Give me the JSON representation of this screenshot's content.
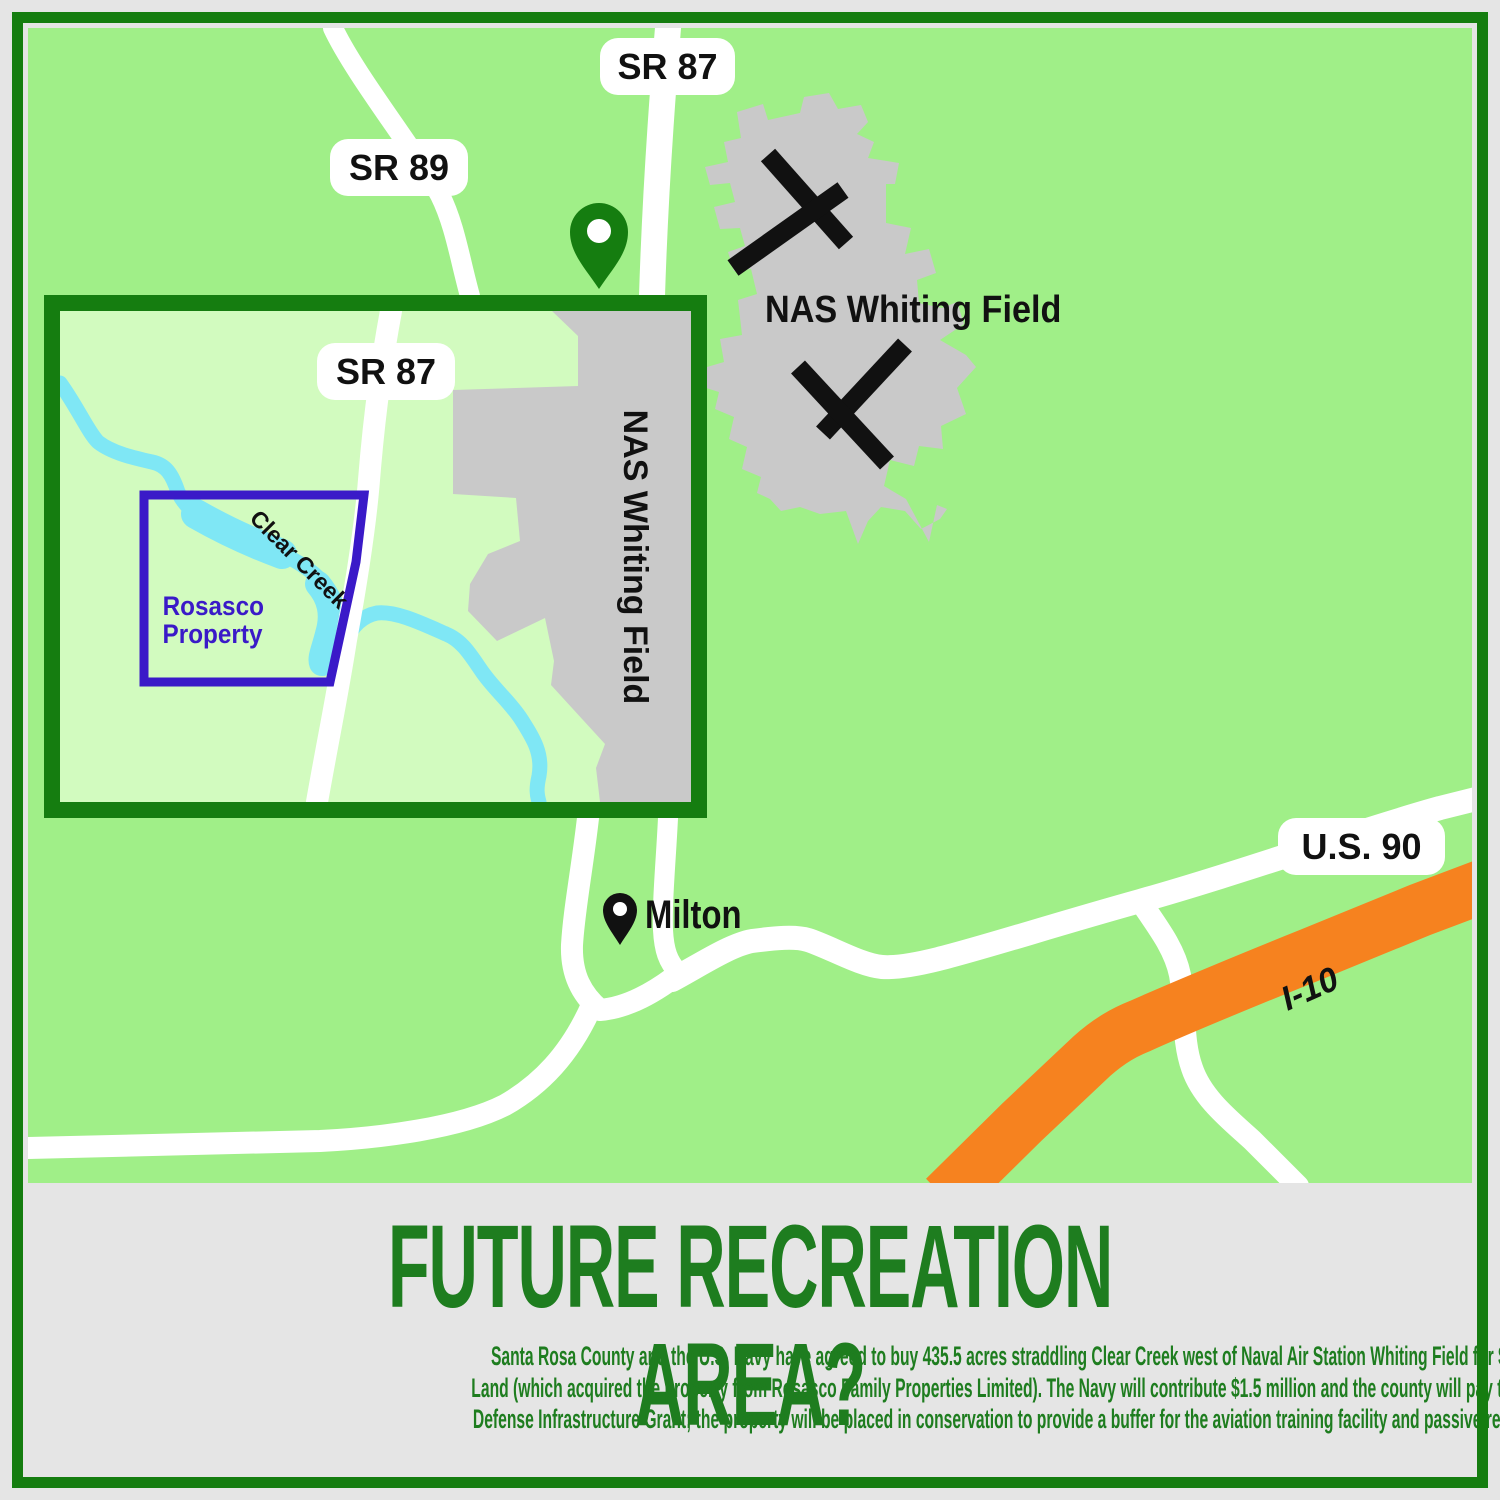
{
  "colors": {
    "bg-gray": "#E5E5E5",
    "frame-green": "#157D10",
    "map-green": "#A0EF88",
    "inset-green": "#D2FBBF",
    "nas-gray": "#C9C9C9",
    "creek-blue": "#7FE7F5",
    "road-white": "#FFFFFF",
    "highway-orange": "#F6821F",
    "property-purple": "#3A1AC8",
    "label-black": "#111111",
    "title-green": "#1E7D1F"
  },
  "map": {
    "road_labels": {
      "sr87_top": "SR 87",
      "sr89": "SR 89",
      "sr87_inset": "SR 87",
      "us90": "U.S. 90",
      "i10": "I-10"
    },
    "place_labels": {
      "nas_main": "NAS Whiting Field",
      "nas_inset": "NAS Whiting Field",
      "milton": "Milton",
      "clear_creek": "Clear Creek",
      "rosasco_line1": "Rosasco",
      "rosasco_line2": "Property"
    }
  },
  "footer": {
    "title": "FUTURE RECREATION AREA?",
    "body_lines": [
      "Santa Rosa County and the U.S. Navy have agreed to buy 435.5 acres straddling Clear Creek west of Naval Air Station Whiting Field for $2.9 million from the Trust for Public",
      "Land (which acquired the property from Rosasco Family Properties Limited). The Navy will contribute $1.5 million and the county will pay the rest from a $1.5 million",
      "Defense Infrastructure Grant; the property will be placed in conservation to provide a buffer for the aviation training facility and passive recreation for area residents."
    ]
  }
}
